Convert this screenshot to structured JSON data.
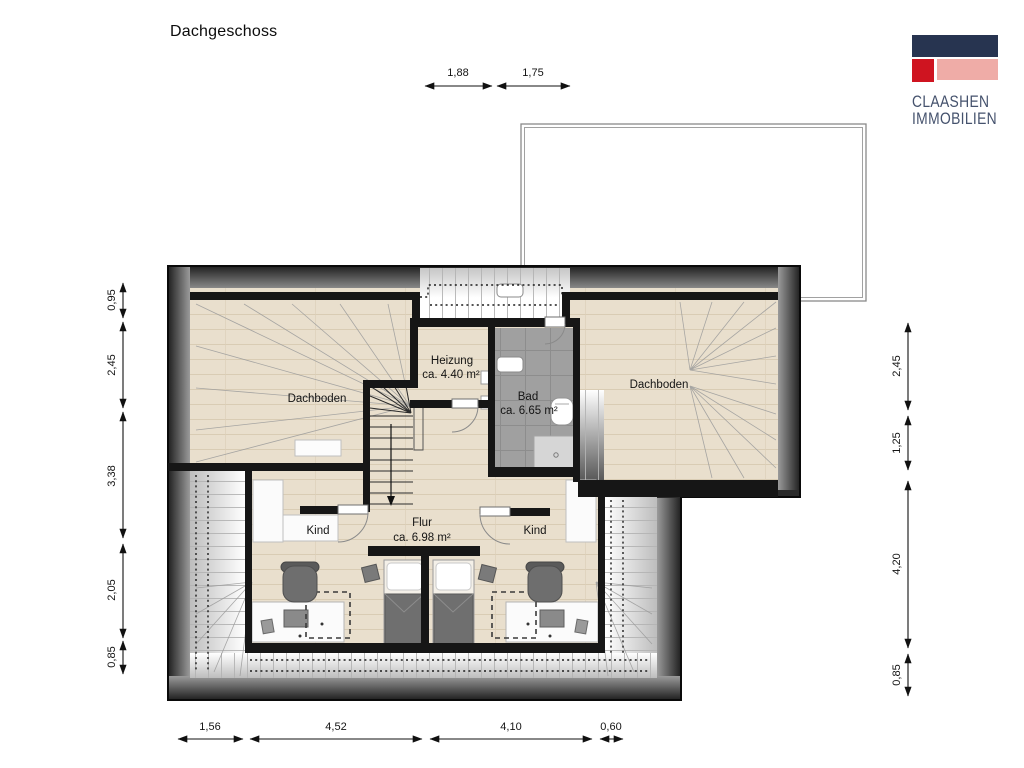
{
  "title": "Dachgeschoss",
  "logo": {
    "line1": "CLAASHEN",
    "line2": "IMMOBILIEN"
  },
  "colors": {
    "brand_navy": "#273450",
    "brand_red": "#cf1420",
    "brand_pink": "#efaca7",
    "brand_text": "#45526d",
    "wall": "#161616",
    "wood": "#e9dfcd",
    "tile": "#a0a0a0"
  },
  "rooms": {
    "dachboden_left": "Dachboden",
    "dachboden_right": "Dachboden",
    "heizung_name": "Heizung",
    "heizung_area": "ca. 4.40 m²",
    "bad_name": "Bad",
    "bad_area": "ca. 6.65 m²",
    "kind_left": "Kind",
    "kind_right": "Kind",
    "flur_name": "Flur",
    "flur_area": "ca. 6.98 m²"
  },
  "dimensions": {
    "top": [
      "1,88",
      "1,75"
    ],
    "left": [
      "0,95",
      "2,45",
      "3,38",
      "2,05",
      "0,85"
    ],
    "right": [
      "2,45",
      "1,25",
      "4,20",
      "0,85"
    ],
    "bottom": [
      "1,56",
      "4,52",
      "4,10",
      "0,60"
    ]
  }
}
